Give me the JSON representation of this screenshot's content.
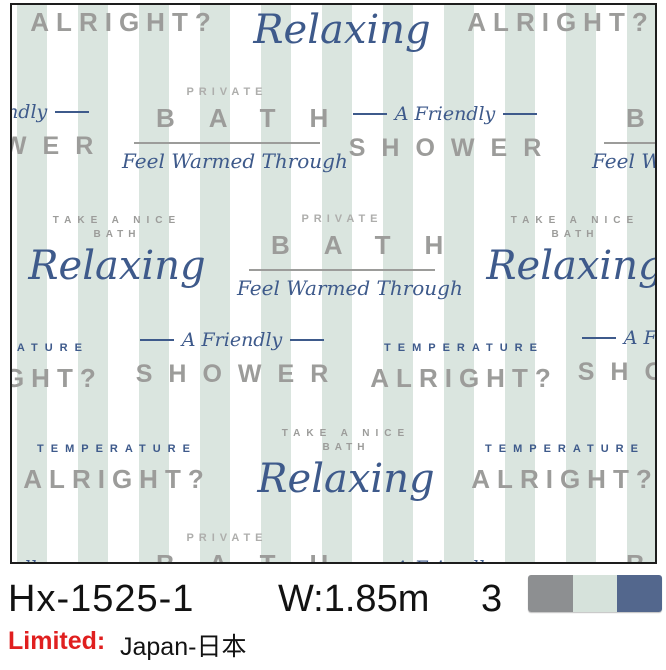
{
  "product": {
    "code": "Hx-1525-1",
    "width_label": "W:1.85m",
    "colors_count": "3",
    "limited_label": "Limited:",
    "limited_value": "Japan-日本",
    "swatches": [
      "#8d8f91",
      "#d6e2db",
      "#53678d"
    ]
  },
  "palette": {
    "stripe_mint": "#dae5df",
    "text_gray": "#9c9c9a",
    "text_gray_light": "#aeaeac",
    "text_navy": "#3e5a8b",
    "frame_black": "#1d1d1d",
    "limited_red": "#e01f1f",
    "info_black": "#121212"
  },
  "pattern_texts": {
    "alright": "ALRIGHT?",
    "temperature": "TEMPERATURE",
    "take_a_nice": "TAKE A NICE",
    "bath_small": "BATH",
    "relaxing": "Relaxing",
    "private": "PRIVATE",
    "bath_big": "BATH",
    "feel_warmed": "Feel Warmed Through",
    "a_friendly": "A Friendly",
    "shower": "SHOWER"
  },
  "pattern": {
    "placements": [
      {
        "type": "temp-alright",
        "cx": 112,
        "top": -18
      },
      {
        "type": "relaxing",
        "cx": 330,
        "top": -25
      },
      {
        "type": "temp-alright",
        "cx": 549,
        "top": -18
      },
      {
        "type": "shower",
        "cx": -15,
        "top": 96
      },
      {
        "type": "bath",
        "cx": 215,
        "top": 82
      },
      {
        "type": "shower",
        "cx": 433,
        "top": 98
      },
      {
        "type": "bath",
        "cx": 685,
        "top": 82
      },
      {
        "type": "relaxing",
        "cx": 105,
        "top": 211
      },
      {
        "type": "bath",
        "cx": 330,
        "top": 209
      },
      {
        "type": "relaxing",
        "cx": 563,
        "top": 211
      },
      {
        "type": "temp-alright",
        "cx": -3,
        "top": 338
      },
      {
        "type": "shower",
        "cx": 220,
        "top": 324
      },
      {
        "type": "temp-alright",
        "cx": 452,
        "top": 338
      },
      {
        "type": "shower",
        "cx": 662,
        "top": 322
      },
      {
        "type": "temp-alright",
        "cx": 105,
        "top": 439
      },
      {
        "type": "relaxing",
        "cx": 334,
        "top": 424
      },
      {
        "type": "temp-alright",
        "cx": 553,
        "top": 439
      },
      {
        "type": "bath",
        "cx": 215,
        "top": 528
      },
      {
        "type": "shower",
        "cx": -15,
        "top": 552
      },
      {
        "type": "shower",
        "cx": 433,
        "top": 552
      },
      {
        "type": "bath",
        "cx": 685,
        "top": 528
      }
    ]
  }
}
